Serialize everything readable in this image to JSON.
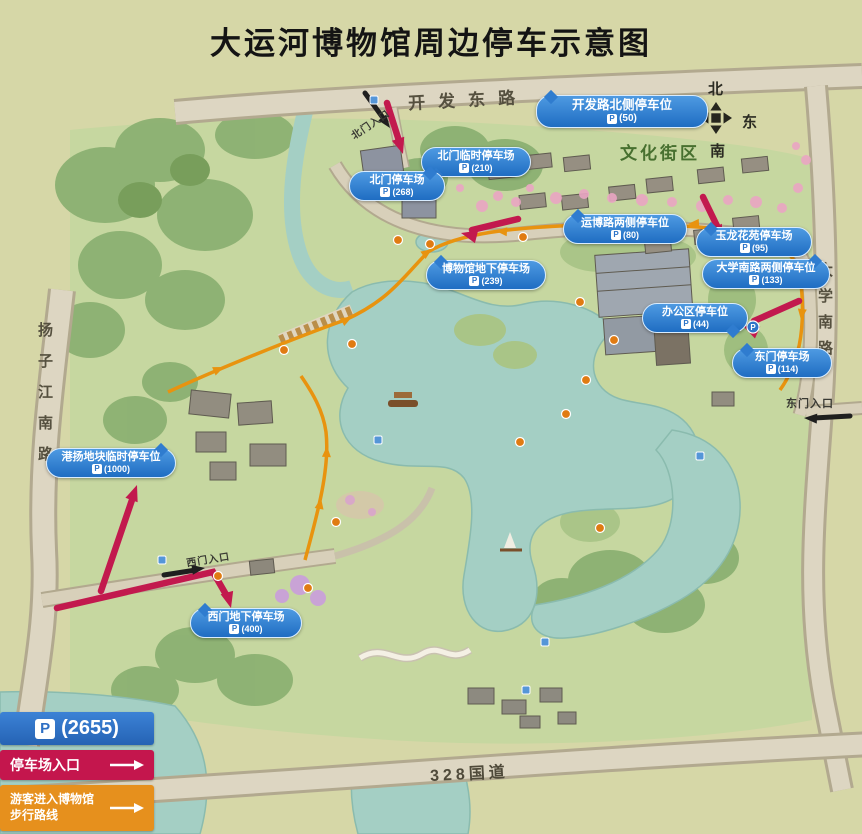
{
  "title": "大运河博物馆周边停车示意图",
  "compass": {
    "north": "北",
    "west": "西",
    "east": "东",
    "south": "南"
  },
  "roads": {
    "top": "开发东路",
    "left": "扬子江南路",
    "right": "大学南路",
    "bottom": "328国道"
  },
  "district": "文化街区",
  "entrances": {
    "north": "北门入口",
    "west": "西门入口",
    "east": "东门入口"
  },
  "icons": {
    "parking": "P"
  },
  "parking": [
    {
      "name": "开发路北侧停车位",
      "capacity": "(50)"
    },
    {
      "name": "北门临时停车场",
      "capacity": "(210)"
    },
    {
      "name": "北门停车场",
      "capacity": "(268)"
    },
    {
      "name": "运博路两侧停车位",
      "capacity": "(80)"
    },
    {
      "name": "玉龙花苑停车场",
      "capacity": "(95)"
    },
    {
      "name": "博物馆地下停车场",
      "capacity": "(239)"
    },
    {
      "name": "大学南路两侧停车位",
      "capacity": "(133)"
    },
    {
      "name": "办公区停车位",
      "capacity": "(44)"
    },
    {
      "name": "东门停车场",
      "capacity": "(114)"
    },
    {
      "name": "港扬地块临时停车位",
      "capacity": "(1000)"
    },
    {
      "name": "西门地下停车场",
      "capacity": "(400)"
    }
  ],
  "legend": {
    "total_value": "(2655)",
    "entrance_label": "停车场入口",
    "walk_label_1": "游客进入博物馆",
    "walk_label_2": "步行路线"
  },
  "colors": {
    "bubble_blue": "#2776cc",
    "legend_blue": "#2e6fc4",
    "entrance_red": "#c4164d",
    "walk_orange": "#e6901d",
    "water": "#a4cfc4",
    "park_green": "#c6d7a0",
    "road_tan": "#ddd6c2"
  }
}
